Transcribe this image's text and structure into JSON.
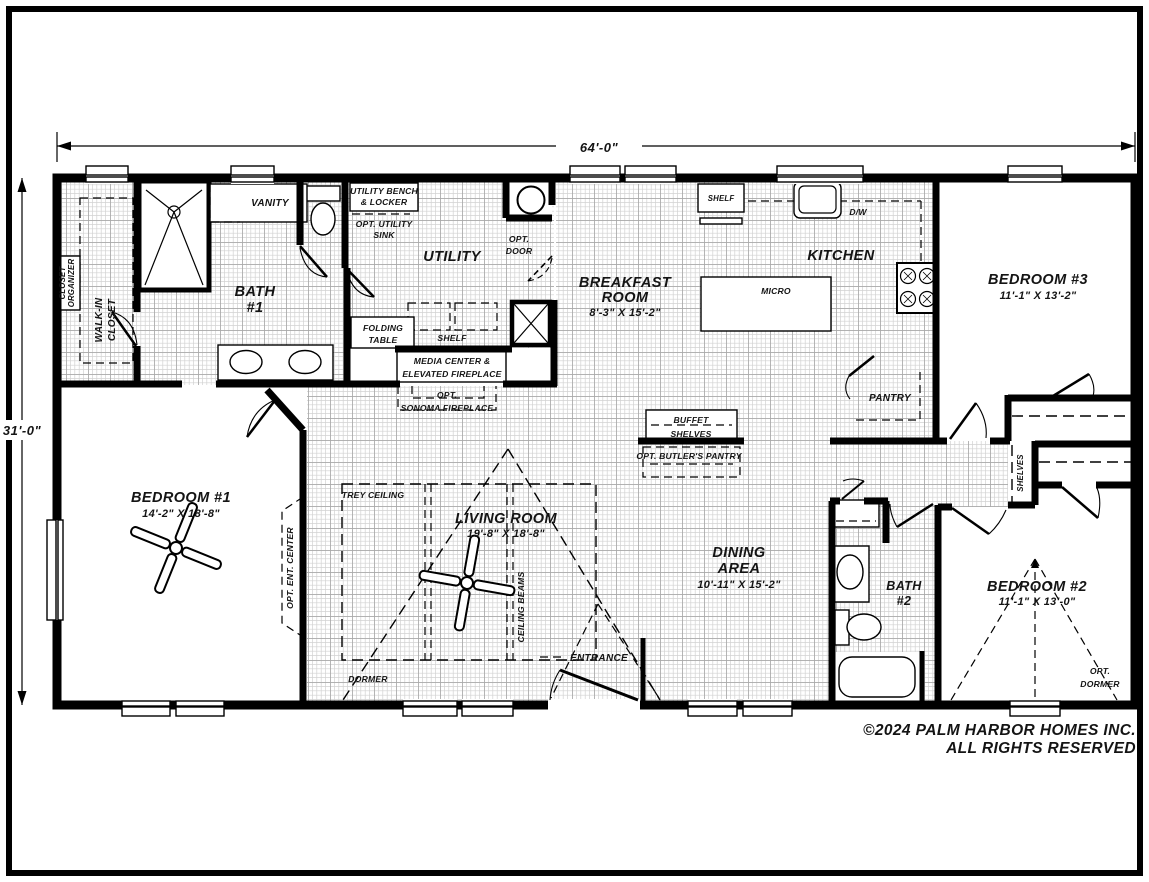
{
  "plan": {
    "overall_width": "64'-0\"",
    "overall_height": "31'-0\"",
    "rooms": {
      "bedroom1": {
        "name": "BEDROOM #1",
        "dims": "14'-2\" X 18'-8\""
      },
      "bedroom2": {
        "name": "BEDROOM #2",
        "dims": "11'-1\" X 13'-0\""
      },
      "bedroom3": {
        "name": "BEDROOM #3",
        "dims": "11'-1\" X 13'-2\""
      },
      "living": {
        "name": "LIVING ROOM",
        "dims": "19'-8\" X 18'-8\""
      },
      "dining": {
        "name1": "DINING",
        "name2": "AREA",
        "dims": "10'-11\" X 15'-2\""
      },
      "breakfast": {
        "name1": "BREAKFAST",
        "name2": "ROOM",
        "dims": "8'-3\" X 15'-2\""
      },
      "kitchen": {
        "name": "KITCHEN"
      },
      "utility": {
        "name": "UTILITY"
      },
      "bath1": {
        "line1": "BATH",
        "line2": "#1"
      },
      "bath2": {
        "line1": "BATH",
        "line2": "#2"
      }
    },
    "labels": {
      "closet_organizer": [
        "CLOSET",
        "ORGANIZER"
      ],
      "walk_in_closet": [
        "WALK-IN",
        "CLOSET"
      ],
      "vanity": "VANITY",
      "utility_bench": [
        "UTILITY BENCH",
        "& LOCKER"
      ],
      "opt_utility_sink": [
        "OPT. UTILITY",
        "SINK"
      ],
      "opt_door": [
        "OPT.",
        "DOOR"
      ],
      "folding_table": [
        "FOLDING",
        "TABLE"
      ],
      "shelf_utility": "SHELF",
      "media_center": [
        "MEDIA CENTER &",
        "ELEVATED FIREPLACE"
      ],
      "opt_sonoma": [
        "OPT.",
        "SONOMA FIREPLACE"
      ],
      "shelf_kitchen": "SHELF",
      "dw": "D/W",
      "micro": "MICRO",
      "pantry": "PANTRY",
      "buffet": [
        "BUFFET",
        "SHELVES"
      ],
      "opt_butlers_pantry": "OPT. BUTLER'S PANTRY",
      "trey_ceiling": "TREY CEILING",
      "ceiling_beams": "CEILING BEAMS",
      "opt_ent_center": "OPT. ENT. CENTER",
      "dormer": "DORMER",
      "entrance": "ENTRANCE",
      "opt_dormer": [
        "OPT.",
        "DORMER"
      ],
      "shelves_closet": "SHELVES",
      "shelves_hall": "SHELVES"
    }
  },
  "footer": {
    "line1": "©2024 PALM HARBOR HOMES INC.",
    "line2": "ALL RIGHTS RESERVED"
  }
}
